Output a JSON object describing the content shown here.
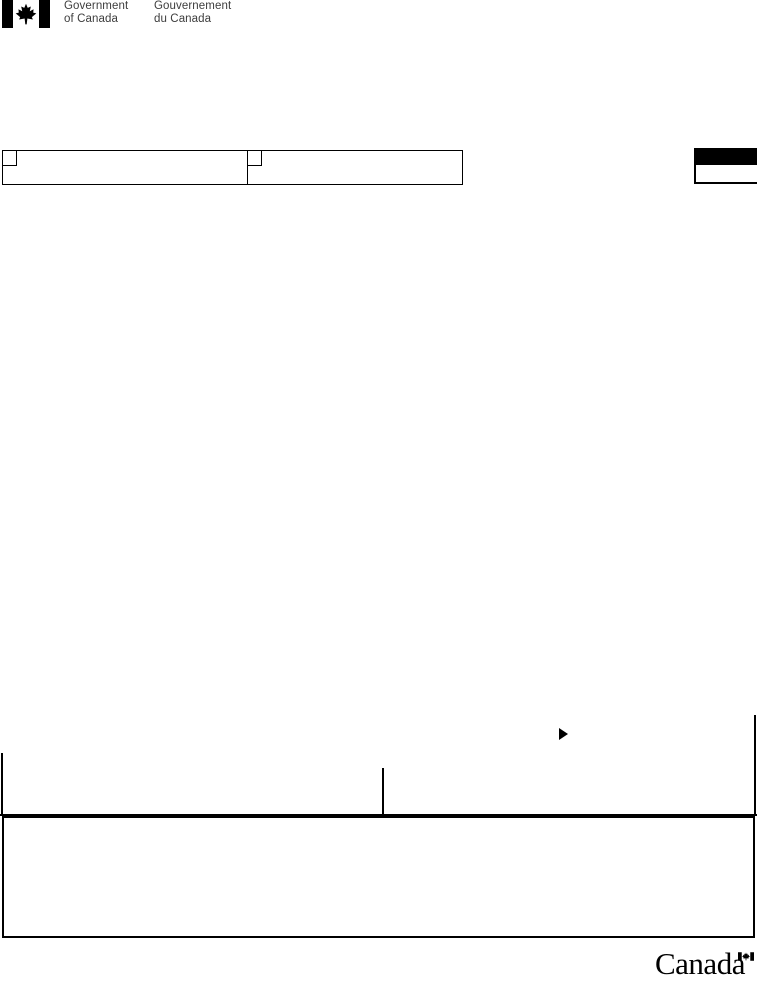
{
  "fip": {
    "flag_icon": "canada-flag",
    "english": [
      "Government",
      "of Canada"
    ],
    "french": [
      "Gouvernement",
      "du Canada"
    ]
  },
  "header_fields": {
    "checkbox_cells": [
      {
        "checkbox_state": "unchecked",
        "value": ""
      },
      {
        "checkbox_state": "unchecked",
        "value": ""
      }
    ],
    "corner_box": {
      "header": "",
      "value": ""
    }
  },
  "body_fields": {
    "arrow_icon": "right-triangle",
    "left_field_value": "",
    "right_field_value": "",
    "large_box_value": ""
  },
  "footer": {
    "wordmark": "Canada",
    "wordmark_flag_icon": "canada-flag"
  },
  "colors": {
    "ink": "#000000",
    "fip_text": "#3d3d3d"
  }
}
